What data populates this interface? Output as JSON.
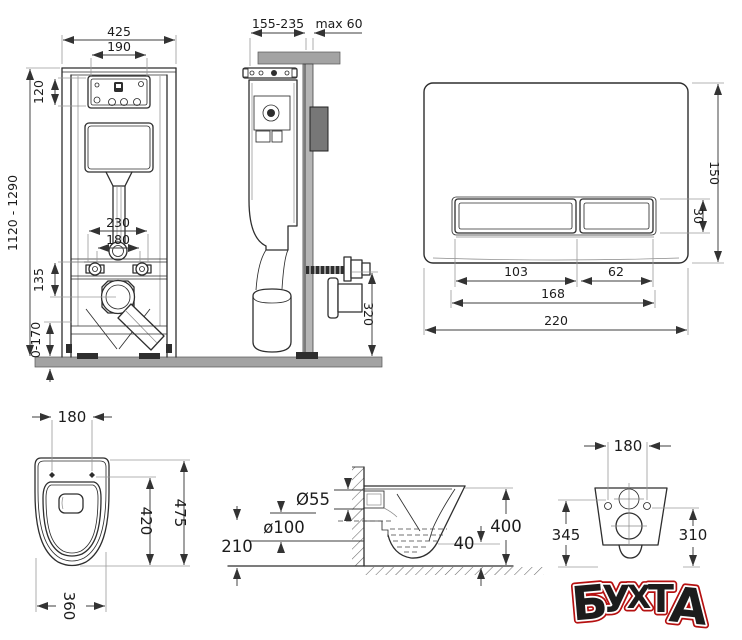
{
  "views": {
    "frame_front": {
      "dims": {
        "overall_width": "425",
        "panel_width": "190",
        "panel_height": "120",
        "height_range": "1120 - 1290",
        "anchor_spacing_outer": "230",
        "anchor_spacing_inner": "180",
        "drain_drop": "135",
        "foot_range": "0-170"
      }
    },
    "frame_side": {
      "dims": {
        "depth_range": "155-235",
        "wall_thickness_max": "max 60",
        "outlet_height": "320"
      }
    },
    "flush_plate": {
      "dims": {
        "plate_height": "150",
        "button_height": "30",
        "large_button_width": "103",
        "small_button_width": "62",
        "buttons_width": "168",
        "plate_width": "220"
      }
    },
    "bowl_top": {
      "dims": {
        "bolt_spacing": "180",
        "outer_length": "475",
        "inner_length": "420",
        "bowl_width": "360"
      }
    },
    "bowl_side": {
      "dims": {
        "flush_pipe": "Ø55",
        "drain_pipe": "ø100",
        "drain_axis_height": "210",
        "rim_gap": "40",
        "bowl_height": "400"
      }
    },
    "bowl_rear": {
      "dims": {
        "bolt_spacing": "180",
        "left_height": "345",
        "right_height": "310"
      }
    }
  },
  "watermark": {
    "text": "БУХТА",
    "letters": [
      "Б",
      "У",
      "Х",
      "Т",
      "А"
    ],
    "color": "#d81a12"
  }
}
